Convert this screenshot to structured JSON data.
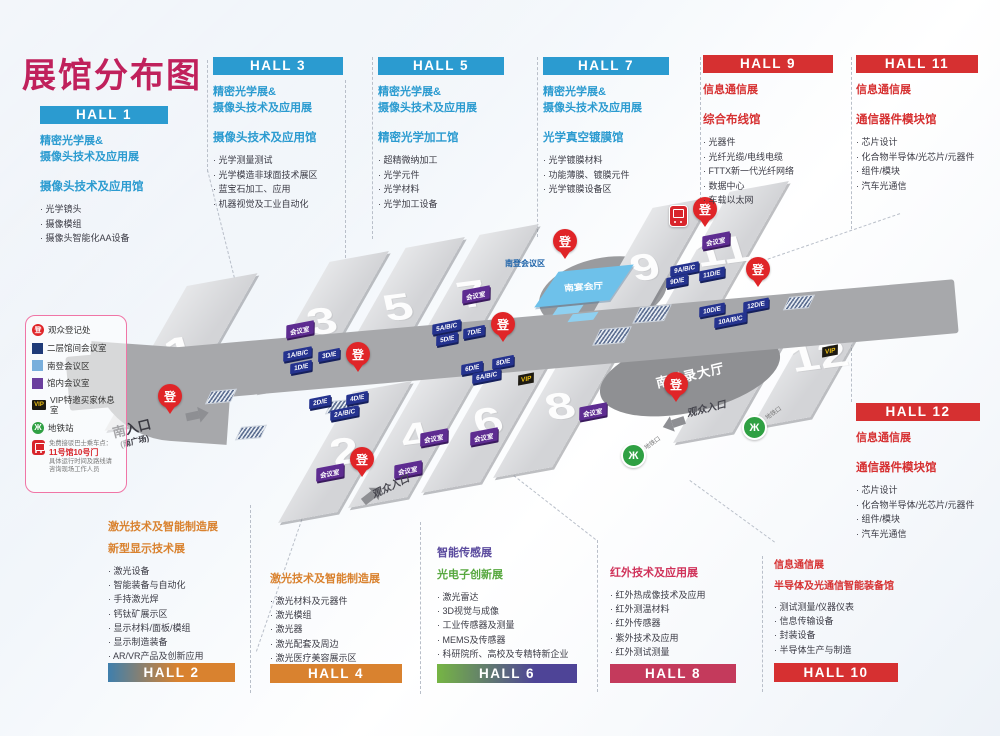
{
  "title": "展馆分布图",
  "panels_top": [
    {
      "id": "hall1",
      "label": "HALL 1",
      "theme": "blue",
      "expo_lines": [
        "精密光学展&",
        "摄像头技术及应用展"
      ],
      "venue": "摄像头技术及应用馆",
      "bullets": [
        "光学镜头",
        "摄像模组",
        "摄像头智能化AA设备"
      ]
    },
    {
      "id": "hall3",
      "label": "HALL 3",
      "theme": "blue",
      "expo_lines": [
        "精密光学展&",
        "摄像头技术及应用展"
      ],
      "venue": "摄像头技术及应用馆",
      "bullets": [
        "光学测量测试",
        "光学模造非球面技术展区",
        "蓝宝石加工、应用",
        "机器视觉及工业自动化"
      ]
    },
    {
      "id": "hall5",
      "label": "HALL 5",
      "theme": "blue",
      "expo_lines": [
        "精密光学展&",
        "摄像头技术及应用展"
      ],
      "venue": "精密光学加工馆",
      "bullets": [
        "超精微纳加工",
        "光学元件",
        "光学材料",
        "光学加工设备"
      ]
    },
    {
      "id": "hall7",
      "label": "HALL 7",
      "theme": "blue",
      "expo_lines": [
        "精密光学展&",
        "摄像头技术及应用展"
      ],
      "venue": "光学真空镀膜馆",
      "bullets": [
        "光学镀膜材料",
        "功能薄膜、镀膜元件",
        "光学镀膜设备区"
      ]
    },
    {
      "id": "hall9",
      "label": "HALL 9",
      "theme": "red",
      "expo_lines": [
        "信息通信展"
      ],
      "venue": "综合布线馆",
      "bullets": [
        "光器件",
        "光纤光缆/电线电缆",
        "FTTX新一代光纤网络",
        "数据中心",
        "车载以太网"
      ]
    },
    {
      "id": "hall11",
      "label": "HALL 11",
      "theme": "red",
      "expo_lines": [
        "信息通信展"
      ],
      "venue": "通信器件模块馆",
      "bullets": [
        "芯片设计",
        "化合物半导体/光芯片/元器件",
        "组件/模块",
        "汽车光通信"
      ]
    }
  ],
  "panel_hall12": {
    "id": "hall12",
    "label": "HALL 12",
    "theme": "red",
    "expo_lines": [
      "信息通信展"
    ],
    "venue": "通信器件模块馆",
    "bullets": [
      "芯片设计",
      "化合物半导体/光芯片/元器件",
      "组件/模块",
      "汽车光通信"
    ]
  },
  "panels_bottom": [
    {
      "id": "hall2",
      "label": "HALL 2",
      "banner": "blueorange",
      "titles": [
        {
          "text": "激光技术及智能制造展",
          "color": "orange"
        },
        {
          "text": "新型显示技术展",
          "color": "orange"
        }
      ],
      "bullets": [
        "激光设备",
        "智能装备与自动化",
        "手持激光焊",
        "钙钛矿展示区",
        "显示材料/面板/模组",
        "显示制造装备",
        "AR/VR产品及创新应用"
      ]
    },
    {
      "id": "hall4",
      "label": "HALL 4",
      "banner": "orange",
      "titles": [
        {
          "text": "激光技术及智能制造展",
          "color": "orange"
        }
      ],
      "bullets": [
        "激光材料及元器件",
        "激光模组",
        "激光器",
        "激光配套及周边",
        "激光医疗美容展示区"
      ]
    },
    {
      "id": "hall6",
      "label": "HALL 6",
      "banner": "greenpurple",
      "titles": [
        {
          "text": "智能传感展",
          "color": "purple"
        },
        {
          "text": "光电子创新展",
          "color": "green"
        }
      ],
      "bullets": [
        "激光雷达",
        "3D视觉与成像",
        "工业传感器及测量",
        "MEMS及传感器",
        "科研院所、高校及专精特新企业"
      ]
    },
    {
      "id": "hall8",
      "label": "HALL 8",
      "banner": "crimson",
      "titles": [
        {
          "text": "红外技术及应用展",
          "color": "crimson"
        }
      ],
      "bullets": [
        "红外热成像技术及应用",
        "红外测温材料",
        "红外传感器",
        "紫外技术及应用",
        "红外测试测量"
      ]
    },
    {
      "id": "hall10",
      "label": "HALL 10",
      "banner": "red",
      "titles": [
        {
          "text": "信息通信展",
          "color": "red"
        },
        {
          "text": "半导体及光通信智能装备馆",
          "color": "red"
        }
      ],
      "bullets": [
        "测试测量/仪器仪表",
        "信息传输设备",
        "封装设备",
        "半导体生产与制造"
      ]
    }
  ],
  "legend": {
    "items": [
      {
        "icon": "registration-pin",
        "label": "观众登记处"
      },
      {
        "icon": "navy-square",
        "label": "二层馆间会议室"
      },
      {
        "icon": "lightblue-square",
        "label": "南登会议区"
      },
      {
        "icon": "purple-square",
        "label": "馆内会议室"
      },
      {
        "icon": "vip-badge",
        "label": "VIP特邀买家休息室"
      },
      {
        "icon": "metro-badge",
        "label": "地铁站"
      },
      {
        "icon": "shuttle-bus",
        "label_lines": [
          "免费接驳巴士乘车点：",
          "11号馆10号门",
          "具体运行时间及路线请",
          "咨询现场工作人员"
        ]
      }
    ]
  },
  "map": {
    "registration_glyph": "登",
    "meeting_label": "会议室",
    "vip_label": "VIP",
    "metro_glyph": "Ж",
    "halls": [
      {
        "id": "1",
        "num": "1"
      },
      {
        "id": "3",
        "num": "3"
      },
      {
        "id": "5",
        "num": "5"
      },
      {
        "id": "7",
        "num": "7"
      },
      {
        "id": "9",
        "num": "9"
      },
      {
        "id": "11",
        "num": "11"
      },
      {
        "id": "2",
        "num": "2"
      },
      {
        "id": "4",
        "num": "4"
      },
      {
        "id": "6",
        "num": "6"
      },
      {
        "id": "8",
        "num": "8"
      },
      {
        "id": "10",
        "num": "10"
      },
      {
        "id": "12",
        "num": "12"
      }
    ],
    "zone_tags": [
      {
        "id": "1abc",
        "text": "1A/B/C"
      },
      {
        "id": "3de",
        "text": "3D/E"
      },
      {
        "id": "1de",
        "text": "1D/E"
      },
      {
        "id": "2de",
        "text": "2D/E"
      },
      {
        "id": "4de",
        "text": "4D/E"
      },
      {
        "id": "2abc",
        "text": "2A/B/C"
      },
      {
        "id": "5abc",
        "text": "5A/B/C"
      },
      {
        "id": "5de",
        "text": "5D/E"
      },
      {
        "id": "7de",
        "text": "7D/E"
      },
      {
        "id": "6de",
        "text": "6D/E"
      },
      {
        "id": "8de",
        "text": "8D/E"
      },
      {
        "id": "6abc",
        "text": "6A/B/C"
      },
      {
        "id": "9abc",
        "text": "9A/B/C"
      },
      {
        "id": "9de",
        "text": "9D/E"
      },
      {
        "id": "11de",
        "text": "11D/E"
      },
      {
        "id": "10de",
        "text": "10D/E"
      },
      {
        "id": "12de",
        "text": "12D/E"
      },
      {
        "id": "10abc",
        "text": "10A/B/C"
      }
    ],
    "meeting_tags": [
      "m3",
      "m7",
      "m11",
      "m2",
      "m4",
      "m6",
      "m6b",
      "m8"
    ],
    "vip_tags": [
      "v8",
      "v12"
    ],
    "pins": [
      "entrance",
      "h3",
      "h5",
      "banquet",
      "h11",
      "h9e",
      "east",
      "h2"
    ],
    "labels": {
      "south_entrance": "南入口",
      "south_entrance_sub": "(南广场)",
      "visitor_entrance_south": "观众入口",
      "visitor_entrance_east": "观众入口",
      "banquet_hall": "南宴会厅",
      "south_registration_hall": "南登录大厅",
      "south_meeting_zone": "南登会议区",
      "metro_exit": "地铁口"
    }
  }
}
